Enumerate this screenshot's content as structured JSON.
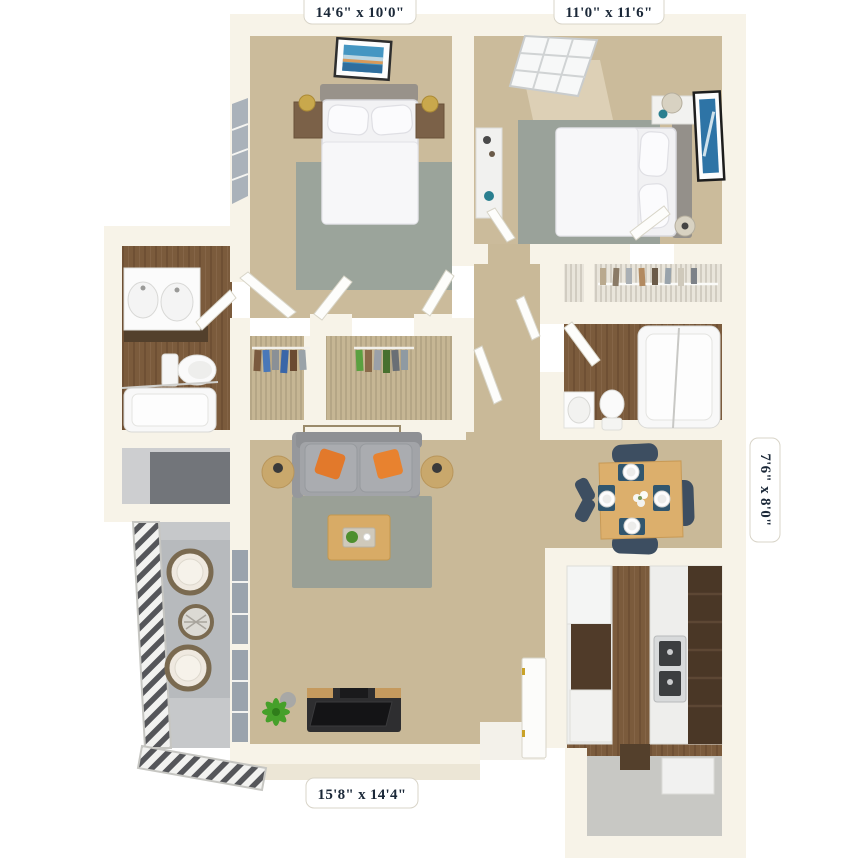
{
  "floor_plan": {
    "type": "3d-apartment-floor-plan-top-down",
    "dimension_labels": {
      "bedroom_top_left": "14'6\" x 10'0\"",
      "bedroom_top_right": "11'0\" x 11'6\"",
      "dining_right": "7'6\" x 8'0\"",
      "living_bottom": "15'8\" x 14'4\""
    },
    "rooms": [
      {
        "name": "bedroom-1",
        "dimensions": "14'6\" x 10'0\""
      },
      {
        "name": "bedroom-2",
        "dimensions": "11'0\" x 11'6\""
      },
      {
        "name": "dining-area",
        "dimensions": "7'6\" x 8'0\""
      },
      {
        "name": "living-room",
        "dimensions": "15'8\" x 14'4\""
      },
      {
        "name": "kitchen"
      },
      {
        "name": "bathroom-1"
      },
      {
        "name": "bathroom-2"
      },
      {
        "name": "walk-in-closets"
      },
      {
        "name": "balcony"
      },
      {
        "name": "entry"
      }
    ],
    "colors": {
      "wall": "#f7f3e8",
      "carpet": "#c9b998",
      "wood_floor": "#7b5b3c",
      "area_rug": "#9aa29a",
      "sofa": "#a2a4a8",
      "accent_pillow": "#e2792b",
      "dining_chair": "#3d4e61",
      "wood_furniture": "#d8ab66",
      "cabinet": "#4e3a28",
      "balcony_floor": "#c6c8ca",
      "label_text": "#1b2838",
      "label_background": "#ffffff"
    }
  }
}
